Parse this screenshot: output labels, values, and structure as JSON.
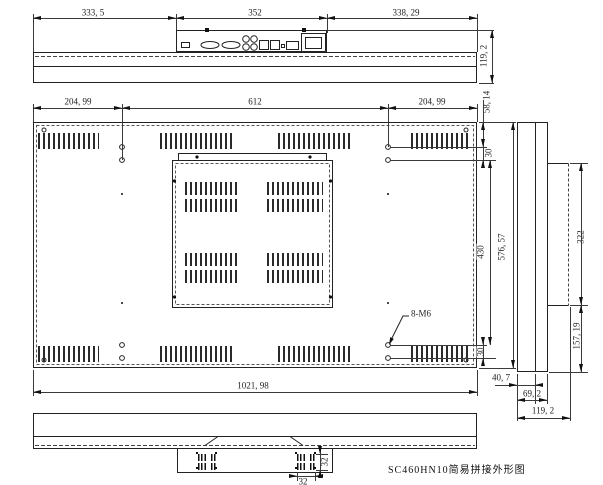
{
  "drawing": {
    "title": "SC460HN10简易拼接外形图"
  },
  "notes": {
    "thread": "8-M6"
  },
  "dims": {
    "top_left": "333, 5",
    "top_center": "352",
    "top_right": "338, 29",
    "top_depth": "119, 2",
    "back_offset_left": "204, 99",
    "back_span": "612",
    "back_offset_right": "204, 99",
    "back_hole_top": "58, 14",
    "back_pitch_top": "30",
    "back_hole_span": "430",
    "back_height": "576, 57",
    "back_pitch_bottom": "30",
    "back_width": "1021, 98",
    "side_box_height": "322",
    "side_box_offset": "157, 19",
    "side_depth_panel": "40, 7",
    "side_depth_mid": "69, 2",
    "side_depth_total": "119, 2",
    "fan_height": "32",
    "fan_width": "32"
  }
}
